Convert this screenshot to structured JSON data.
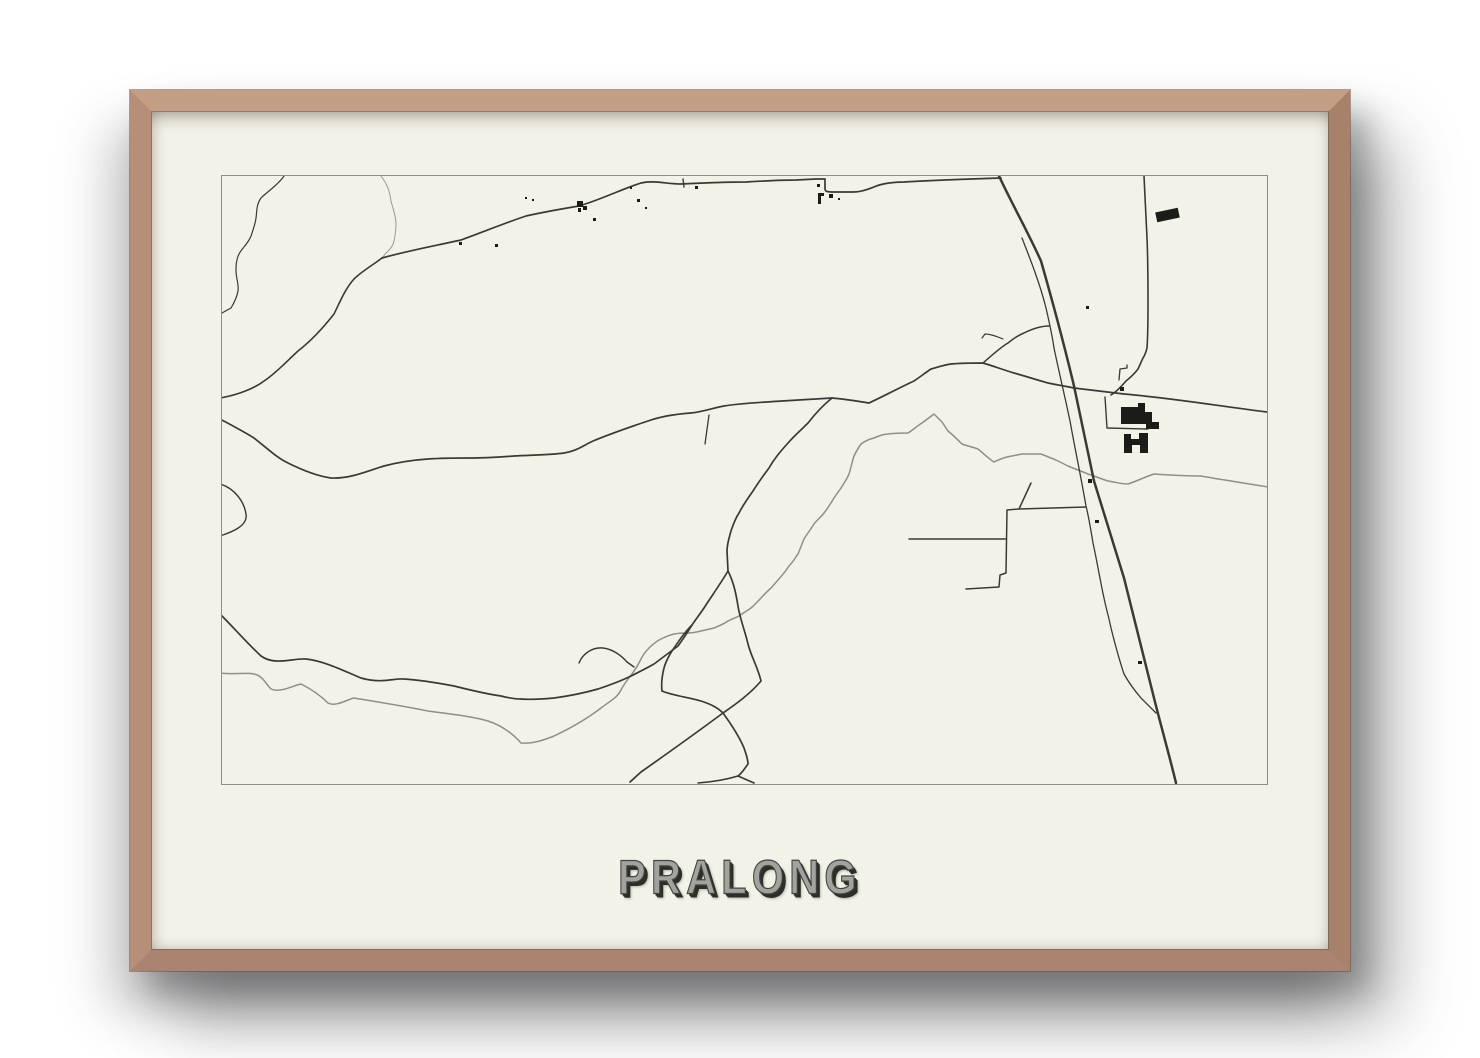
{
  "poster": {
    "title": "PRALONG"
  },
  "colors": {
    "background": "#ffffff",
    "frame_wood": "#b48d76",
    "paper": "#f3f2e8",
    "map_border": "#8e8e86",
    "road": "#3a3a35",
    "water": "#8f8f88",
    "building": "#1b1b17",
    "title_fill": "#a2a29e",
    "title_outline": "#45453f",
    "title_shadow": "#2e2e29"
  },
  "map": {
    "width": 1045,
    "height": 608,
    "waterways": [
      {
        "name": "small-arc-stream",
        "w": 1.0,
        "c": "#9a9a93",
        "d": "M159,0 C166,9 168,17 169,25 C171,33 174,40 174,48 C174,56 173,60 172,65 C171,71 167,74 164,77 L160,82"
      },
      {
        "name": "main-river",
        "w": 1.5,
        "d": "M-2,497 C10,499 24,496 32,498 C41,500 44,508 49,513 C58,517 70,510 79,508 C89,513 99,520 106,527 C114,531 124,524 132,522 C156,526 182,530 206,535 C227,538 249,540 266,545 C281,550 292,559 299,567 C311,568 322,564 332,560 C349,552 366,542 379,532 C388,525 395,522 399,514 C403,506 408,501 412,495 C415,491 417,487 419,483 C421,479 424,475 427,472 C431,468 435,465 439,463 C443,461 448,459 452,458 C457,457 461,457 466,457 C470,457 475,456 479,455 C483,454 488,453 492,452 C497,450 502,448 506,445 C510,443 513,442 517,440 C521,437 525,435 529,432 C536,426 542,418 549,412 C555,405 562,398 567,390 C571,386 573,382 576,378 C578,373 580,368 582,363 C585,358 589,353 592,348 C595,344 599,341 602,337 C606,332 609,327 612,322 C614,319 617,315 619,312 C622,307 625,303 627,298 C629,292 630,286 632,280 C634,276 636,272 639,268 C643,265 648,263 652,262 C657,260 661,258 666,258 C673,257 679,257 686,257 C691,254 695,250 700,247 C704,244 708,241 712,238 C715,241 717,243 720,246 C722,249 724,252 726,255 C731,259 736,264 740,268 C745,270 751,271 756,273 C761,277 767,283 772,286 C776,284 781,282 785,281 C790,280 795,279 800,278 C806,278 813,278 819,278 C824,280 829,282 834,284 C838,286 842,288 846,290 C853,293 859,295 866,298 C873,300 879,303 886,305 C893,306 899,308 906,308 C915,305 923,301 932,298 C947,299 963,300 979,300 C1001,304 1023,307 1046,311"
      }
    ],
    "roads": [
      {
        "name": "stream-topleft",
        "w": 1.2,
        "d": "M62,0 C56,9 46,15 39,22 C34,29 35,36 34,42 C33,49 31,54 29,60 C26,68 20,72 17,78 C14,84 14,90 14,95 C14,102 17,108 16,115 C15,121 12,127 9,132 L-2,138"
      },
      {
        "name": "road-to-left-border",
        "w": 1.6,
        "d": "M160,82 C151,89 140,95 132,103 C123,113 118,126 112,138 C101,152 89,165 76,175 C64,186 53,198 42,205 C33,212 16,219 -2,222"
      },
      {
        "name": "top-road",
        "w": 1.7,
        "d": "M160,82 C185,75 212,70 239,64 C261,56 283,47 304,40 C322,36 339,33 357,30 C378,24 400,13 419,7 C432,4 445,8 459,8 C480,7 502,6 524,6 C541,5 560,4 574,4 L594,3 L603,3 L603,13 C603,16 607,16 612,16 L632,16 C640,16 647,13 652,11 C658,8 670,6 682,6 C714,4 746,3 779,2"
      },
      {
        "name": "border-tick",
        "w": 1.4,
        "d": "M461,3 L462,11"
      },
      {
        "name": "mid-left-road",
        "w": 1.7,
        "d": "M-2,243 C15,252 24,257 32,262 C45,272 55,282 66,287 C80,294 95,300 109,302 C128,303 145,295 162,290 C177,286 191,284 206,283 C220,282 235,282 249,282 C263,282 278,281 292,280 C309,279 328,279 342,277 C355,275 362,269 371,265 C388,258 408,251 426,245 C440,240 455,238 469,237 C480,236 491,232 502,230 C520,227 545,226 560,225 C577,224 593,223 610,222"
      },
      {
        "name": "short-stub",
        "w": 1.3,
        "d": "M487,239 L483,268"
      },
      {
        "name": "east-horizontal-road",
        "w": 1.7,
        "d": "M1045,236 C997,230 950,222 902,218 C885,216 869,214 852,212 C843,210 835,209 826,207 C815,204 803,200 792,197 C782,194 771,190 761,187 C750,187 740,187 729,188 C722,189 716,191 709,193 C703,197 698,201 692,205 C677,212 662,220 647,227 C635,225 622,223 610,222"
      },
      {
        "name": "s-descent",
        "w": 1.7,
        "d": "M610,222 C600,230 593,238 586,247 C578,255 572,260 566,267 C558,276 552,283 547,292 C541,300 536,307 531,315 C526,322 521,329 517,337 C513,343 511,349 509,355 C507,362 505,368 505,375 L506,395"
      },
      {
        "name": "branch-southwest",
        "w": 1.7,
        "d": "M506,395 C497,410 489,421 482,432 C478,438 474,443 470,449 C465,454 462,458 459,462 C452,472 445,481 442,492 C440,500 439,507 440,515"
      },
      {
        "name": "branch-southeast",
        "w": 1.7,
        "d": "M506,395 C512,407 514,418 516,430 C518,443 523,455 526,468 C529,480 536,492 539,505 C528,518 514,528 501,537 C474,557 446,577 419,596 L408,606"
      },
      {
        "name": "bottom-arc",
        "w": 1.7,
        "d": "M440,515 C452,520 466,521 479,525 C488,528 495,531 501,537 C509,548 517,560 522,572 C524,578 526,583 526,588 C523,592 520,597 516,600 L532,607"
      },
      {
        "name": "bottom-fork-left",
        "w": 1.6,
        "d": "M516,600 C503,604 489,606 476,607"
      },
      {
        "name": "bottom-smile-road",
        "w": 1.7,
        "d": "M-2,438 C12,452 26,468 39,480 C53,490 70,482 84,483 C102,485 120,494 139,502 C160,508 172,502 182,503 C199,504 216,507 232,510 C248,514 264,518 279,520 C287,522 293,523 299,523 C310,524 321,523 332,522 C347,520 362,517 376,513 C388,509 399,505 409,500 C417,496 425,492 432,488 C440,482 448,476 456,470 C461,463 466,456 470,449"
      },
      {
        "name": "small-hook",
        "w": 1.4,
        "d": "M357,487 C361,477 371,471 381,472 C390,473 399,479 405,486 L412,491"
      },
      {
        "name": "left-border-bump",
        "w": 1.4,
        "d": "M-2,308 C12,312 22,325 24,338 C26,350 10,356 -2,360"
      },
      {
        "name": "highway",
        "w": 2.5,
        "d": "M777,0 C790,28 806,56 819,85 C831,127 842,168 852,210 C859,242 865,273 872,305 C882,337 892,370 902,402 C912,442 922,482 932,522 C939,550 947,578 954,607"
      },
      {
        "name": "highway-side-road",
        "w": 1.3,
        "d": "M800,62 C809,85 818,108 824,132 C827,145 830,158 832,172 C837,196 843,221 848,245 C853,273 859,301 864,330 C867,342 869,355 871,367 C875,385 878,404 882,422 C884,432 887,442 889,452 C893,468 897,483 902,498 C907,507 913,515 919,522 C924,527 929,532 934,537"
      },
      {
        "name": "ne-diagonal-link",
        "w": 1.5,
        "d": "M761,187 C770,179 779,171 786,167 C792,162 797,159 802,157 C810,153 818,150 827,150"
      },
      {
        "name": "diagonal-branch-tick",
        "w": 1.2,
        "d": "M781,163 C774,160 768,158 763,158 L760,162"
      },
      {
        "name": "vertical-road-right",
        "w": 1.6,
        "d": "M922,0 C923,21 924,41 925,62 C926,84 926,106 926,128 C926,143 926,158 925,172 C924,176 923,179 921,182 C919,186 918,189 916,193 C913,197 909,201 904,205 C899,211 894,216 889,219"
      },
      {
        "name": "tiny-hook-road",
        "w": 1.3,
        "d": "M905,189 L905,192 L898,193 L897,204"
      },
      {
        "name": "factory-enclosure",
        "w": 1.4,
        "d": "M883,221 L885,252 L926,253"
      },
      {
        "name": "staple-roads",
        "w": 1.5,
        "d": "M809,307 L797,333 M797,333 L864,331 M797,333 L785,334 L784,397 L778,399 L777,411 L744,413 M687,363 L784,363"
      }
    ],
    "buildings": {
      "rects": [
        [
          237,
          66,
          3,
          3,
          0
        ],
        [
          273,
          68,
          3,
          3,
          0
        ],
        [
          303,
          21,
          2,
          2,
          0
        ],
        [
          310,
          23,
          2,
          2,
          0
        ],
        [
          355,
          25,
          6,
          6,
          0
        ],
        [
          361,
          30,
          4,
          4,
          0
        ],
        [
          356,
          32,
          3,
          4,
          0
        ],
        [
          371,
          42,
          3,
          3,
          0
        ],
        [
          408,
          11,
          2,
          2,
          0
        ],
        [
          415,
          23,
          3,
          3,
          0
        ],
        [
          423,
          31,
          2,
          2,
          0
        ],
        [
          473,
          10,
          3,
          3,
          0
        ],
        [
          595,
          8,
          3,
          3,
          0
        ],
        [
          607,
          18,
          4,
          4,
          0
        ],
        [
          616,
          22,
          2,
          2,
          0
        ],
        [
          934,
          34,
          23,
          10,
          -12
        ],
        [
          864,
          130,
          3,
          3,
          0
        ],
        [
          898,
          211,
          4,
          4,
          0
        ],
        [
          866,
          303,
          4,
          4,
          0
        ],
        [
          873,
          344,
          4,
          3,
          0
        ],
        [
          916,
          485,
          4,
          3,
          0
        ]
      ],
      "paths": [
        "M596,17 L602,17 L602,20 L599,20 L599,28 L596,28 Z",
        "M899,231 L916,231 L916,227 L923,227 L923,236 L930,236 L930,246 L937,246 L937,253 L924,253 L924,248 L899,248 Z",
        "M902,258 L909,258 L909,263 L917,263 L917,257 L926,257 L926,277 L918,277 L918,269 L910,269 L910,277 L902,277 Z"
      ]
    }
  }
}
